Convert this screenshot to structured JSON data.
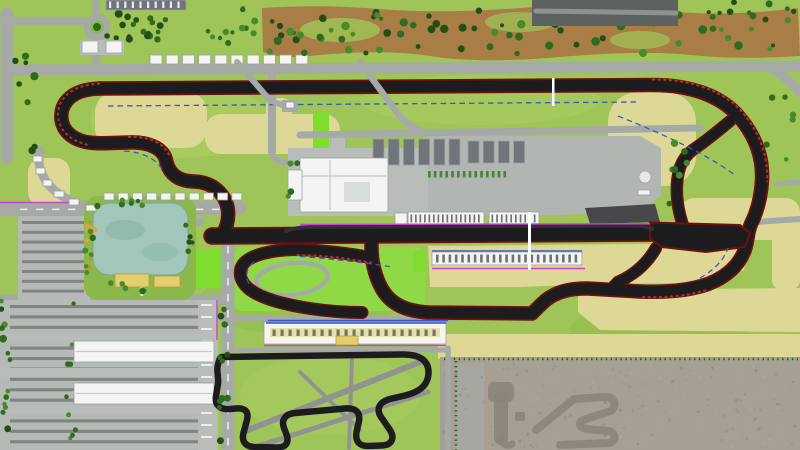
{
  "meta": {
    "description": "Aerial master-plan rendering of a motorsport circuit complex with grand-prix track, pit paddock, karting track, lake park, parking lots and undeveloped scrubland",
    "width_px": 800,
    "height_px": 450
  },
  "features": [
    "main-circuit",
    "back-straight",
    "main-straight",
    "west-hairpin",
    "esses",
    "right-complex",
    "infield-loop",
    "pit-lane",
    "pit-boxes",
    "paddock",
    "race-control-building",
    "garages",
    "grandstands",
    "karting-track",
    "kart-grandstand",
    "lake",
    "lake-park",
    "entrance-roundabout",
    "entrance-gate",
    "parking-lot-south",
    "parking-lot-west",
    "scrubland",
    "legacy-track",
    "helipad",
    "tree-belt",
    "service-roads"
  ],
  "palette": {
    "grass": "#9fc558",
    "grassLight": "#b4d169",
    "grassDark": "#8ab84a",
    "brightGreen": "#8fd846",
    "lime": "#80dc2f",
    "dryGrass": "#ded896",
    "paleGrass": "#cfd98c",
    "dirt": "#a87e46",
    "tree": "#2f6b1d",
    "treeDark": "#234f15",
    "treeLight": "#478a2c",
    "road": "#a6aaa6",
    "roadLight": "#b9bdb9",
    "roadMid": "#8f9492",
    "roadDark": "#5d6260",
    "parking": "#b6bab6",
    "parkRow": "#54585a",
    "building": "#f4f5f2",
    "buildingEdge": "#9aa0a0",
    "garage": "#6f757a",
    "paddock": "#b2b6b2",
    "lake": "#a2c7ba",
    "lakeDeep": "#8cb7aa",
    "lakeEdge": "#82a794",
    "track": "#1c1c1f",
    "curb": "#701010",
    "curbBright": "#c03a2e",
    "pitlane": "#303034",
    "fence": "#cf3fd0",
    "drain": "#3a56c4",
    "scrub": "#a89f94",
    "scrubPad": "#a7a7a2",
    "legacy": "#8a847b",
    "yellowBldg": "#e3cf6d",
    "yellowEdge": "#b29c3c",
    "orange": "#d9832c",
    "white": "#ffffff",
    "tick": "#70747a"
  },
  "generated": [
    {
      "id": "gs-north",
      "kind": "repeat",
      "name": "grandstand-block",
      "x": 150,
      "y": 55,
      "dx": 16.2,
      "count": 10,
      "w": 12,
      "h": 9,
      "fill": "building",
      "stroke": "buildingEdge"
    },
    {
      "id": "gs-west2",
      "kind": "repeat",
      "name": "grandstand-block",
      "x": 104,
      "y": 193,
      "dx": 14.2,
      "count": 10,
      "w": 10,
      "h": 7,
      "fill": "building",
      "stroke": "buildingEdge"
    },
    {
      "id": "pitticksA",
      "kind": "repeat",
      "name": "pit-box",
      "x": 410.5,
      "y": 214.5,
      "dx": 4.5,
      "count": 16,
      "w": 1.7,
      "h": 8,
      "fill": "tick"
    },
    {
      "id": "pitticksB",
      "kind": "repeat",
      "name": "pit-box",
      "x": 491.5,
      "y": 214.5,
      "dx": 4.7,
      "count": 10,
      "w": 1.7,
      "h": 8,
      "fill": "tick"
    },
    {
      "id": "ygsticks",
      "kind": "repeat",
      "name": "grandstand-seat-row",
      "x": 436,
      "y": 254.5,
      "dx": 6.3,
      "count": 23,
      "w": 2.6,
      "h": 8,
      "fill": "tick"
    },
    {
      "id": "kartticks",
      "kind": "repeat",
      "name": "grandstand-seat-row",
      "x": 272.5,
      "y": 329.5,
      "dx": 8,
      "count": 21,
      "w": 3.2,
      "h": 6.5,
      "fill": "tick"
    },
    {
      "id": "garagesA",
      "kind": "repeat",
      "name": "garage-building",
      "x": 373,
      "y": 139,
      "dx": 15.2,
      "count": 6,
      "w": 11,
      "h": 26,
      "fill": "garage",
      "stroke": "buildingEdge"
    },
    {
      "id": "garagesB",
      "kind": "repeat",
      "name": "garage-building",
      "x": 468,
      "y": 141,
      "dx": 15.2,
      "count": 4,
      "w": 11,
      "h": 22,
      "fill": "garage",
      "stroke": "buildingEdge"
    },
    {
      "id": "topbldgticks",
      "kind": "repeat",
      "name": "building-bay",
      "x": 109,
      "y": 1.5,
      "dx": 7.6,
      "count": 10,
      "w": 2.2,
      "h": 6.5,
      "fill": "white",
      "opacity": 0.85
    },
    {
      "id": "road210dash",
      "kind": "repeat",
      "name": "road-marking",
      "x": 20,
      "y": 208.6,
      "dx": 16,
      "count": 13,
      "w": 7.5,
      "h": 1.6,
      "fill": "white",
      "opacity": 0.75
    },
    {
      "id": "road228dash",
      "kind": "repeat",
      "name": "road-marking",
      "x": 227.2,
      "y": 214,
      "dy": 16,
      "count": 15,
      "w": 1.6,
      "h": 7.5,
      "fill": "white",
      "opacity": 0.75
    },
    {
      "id": "parkrowS",
      "kind": "repeat",
      "name": "parking-row",
      "x": 10,
      "y": 305,
      "dy": 10.4,
      "count": 14,
      "w": 188,
      "h": 3.1,
      "fill": "parkRow",
      "opacity": 0.55
    },
    {
      "id": "parkrowW",
      "kind": "repeat",
      "name": "parking-row",
      "x": 22,
      "y": 221,
      "dy": 9.8,
      "count": 8,
      "w": 62,
      "h": 3,
      "fill": "parkRow",
      "opacity": 0.55
    },
    {
      "id": "baysE",
      "kind": "repeat",
      "name": "parking-bay",
      "x": 201,
      "y": 304,
      "dy": 12,
      "count": 12,
      "w": 11,
      "h": 2,
      "fill": "white",
      "opacity": 0.7
    },
    {
      "id": "paddockcars",
      "kind": "repeat",
      "name": "parked-car",
      "x": 428,
      "y": 171,
      "dx": 5.8,
      "count": 14,
      "w": 2.7,
      "h": 6.5,
      "fill": "#3f7d2b",
      "opacity": 0.9
    },
    {
      "id": "t-dirt",
      "kind": "scatter",
      "name": "tree",
      "x": 266,
      "y": 10,
      "w": 528,
      "h": 44,
      "count": 74,
      "rmin": 2,
      "rmax": 4.4,
      "seed": 2,
      "colors": [
        "tree",
        "treeLight",
        "treeDark"
      ]
    },
    {
      "id": "t-orchard",
      "kind": "scatter",
      "name": "tree",
      "x": 188,
      "y": 8,
      "w": 76,
      "h": 42,
      "count": 13,
      "rmin": 2,
      "rmax": 3.6,
      "seed": 3,
      "colors": [
        "tree",
        "treeLight"
      ]
    },
    {
      "id": "t-topright",
      "kind": "scatter",
      "name": "tree",
      "x": 682,
      "y": 2,
      "w": 114,
      "h": 20,
      "count": 10,
      "rmin": 2,
      "rmax": 3.8,
      "seed": 4,
      "colors": [
        "tree",
        "treeDark"
      ]
    },
    {
      "id": "t-rightstrip",
      "kind": "scatter",
      "name": "tree",
      "x": 764,
      "y": 96,
      "w": 32,
      "h": 82,
      "count": 6,
      "rmin": 2,
      "rmax": 3.5,
      "seed": 5,
      "colors": [
        "tree",
        "treeLight"
      ]
    },
    {
      "id": "t-leftroad",
      "kind": "scatter",
      "name": "tree",
      "x": 15,
      "y": 56,
      "w": 20,
      "h": 96,
      "count": 9,
      "rmin": 2.4,
      "rmax": 4.2,
      "seed": 6,
      "colors": [
        "tree",
        "treeDark"
      ]
    },
    {
      "id": "t-hedge1",
      "kind": "scatter",
      "name": "hedge-tree",
      "x": 118,
      "y": 13,
      "w": 62,
      "h": 13,
      "count": 9,
      "rmin": 2.4,
      "rmax": 4,
      "seed": 7,
      "colors": [
        "tree",
        "treeDark"
      ]
    },
    {
      "id": "t-hedge2",
      "kind": "scatter",
      "name": "hedge-tree",
      "x": 104,
      "y": 31,
      "w": 78,
      "h": 11,
      "count": 10,
      "rmin": 2.2,
      "rmax": 3.8,
      "seed": 8,
      "colors": [
        "tree",
        "treeDark"
      ]
    },
    {
      "id": "t-lakeL",
      "kind": "scatter",
      "name": "tree",
      "x": 84,
      "y": 205,
      "w": 10,
      "h": 72,
      "count": 6,
      "rmin": 2,
      "rmax": 3.4,
      "seed": 9,
      "colors": [
        "tree",
        "treeLight"
      ]
    },
    {
      "id": "t-lakeT",
      "kind": "scatter",
      "name": "tree",
      "x": 94,
      "y": 197,
      "w": 96,
      "h": 9,
      "count": 7,
      "rmin": 2,
      "rmax": 3.2,
      "seed": 10,
      "colors": [
        "tree",
        "treeLight"
      ]
    },
    {
      "id": "t-lakeR",
      "kind": "scatter",
      "name": "tree",
      "x": 184,
      "y": 207,
      "w": 10,
      "h": 66,
      "count": 5,
      "rmin": 2,
      "rmax": 3.2,
      "seed": 11,
      "colors": [
        "tree",
        "treeDark"
      ]
    },
    {
      "id": "t-lakeB",
      "kind": "scatter",
      "name": "tree",
      "x": 98,
      "y": 283,
      "w": 84,
      "h": 10,
      "count": 5,
      "rmin": 2,
      "rmax": 3.2,
      "seed": 12,
      "colors": [
        "tree",
        "treeLight"
      ]
    },
    {
      "id": "t-pkEdge",
      "kind": "scatter",
      "name": "tree",
      "x": 1,
      "y": 300,
      "w": 12,
      "h": 148,
      "count": 13,
      "rmin": 2.2,
      "rmax": 4,
      "seed": 13,
      "colors": [
        "tree",
        "treeLight",
        "treeDark"
      ]
    },
    {
      "id": "t-pkMid",
      "kind": "scatter",
      "name": "tree",
      "x": 66,
      "y": 302,
      "w": 10,
      "h": 146,
      "count": 9,
      "rmin": 2,
      "rmax": 3.4,
      "seed": 14,
      "colors": [
        "tree",
        "treeLight"
      ]
    },
    {
      "id": "t-midroad",
      "kind": "scatter",
      "name": "tree",
      "x": 219,
      "y": 302,
      "w": 14,
      "h": 146,
      "count": 11,
      "rmin": 2,
      "rmax": 3.6,
      "seed": 15,
      "colors": [
        "tree",
        "treeDark"
      ]
    },
    {
      "id": "t-padEast",
      "kind": "scatter",
      "name": "tree",
      "x": 663,
      "y": 142,
      "w": 34,
      "h": 66,
      "count": 7,
      "rmin": 2.2,
      "rmax": 3.8,
      "seed": 16,
      "colors": [
        "tree",
        "treeLight"
      ]
    },
    {
      "id": "t-padWest",
      "kind": "scatter",
      "name": "tree",
      "x": 287,
      "y": 152,
      "w": 15,
      "h": 58,
      "count": 4,
      "rmin": 2.2,
      "rmax": 3.6,
      "seed": 17,
      "colors": [
        "tree",
        "treeLight"
      ]
    },
    {
      "id": "flowers",
      "kind": "scatter",
      "name": "flower-bed",
      "x": 86,
      "y": 211,
      "w": 9,
      "h": 58,
      "count": 9,
      "rmin": 1.4,
      "rmax": 2.6,
      "seed": 19,
      "colors": [
        "orange",
        "#e0a33f"
      ]
    },
    {
      "id": "speck",
      "kind": "scatter",
      "name": "scrub-vegetation",
      "x": 442,
      "y": 364,
      "w": 354,
      "h": 84,
      "count": 240,
      "rmin": 0.7,
      "rmax": 1.8,
      "seed": 20,
      "opacity": 0.55,
      "colors": [
        "#99917f",
        "#b3a89c",
        "#879a79",
        "#7d8c72",
        "#b1a392"
      ]
    }
  ]
}
